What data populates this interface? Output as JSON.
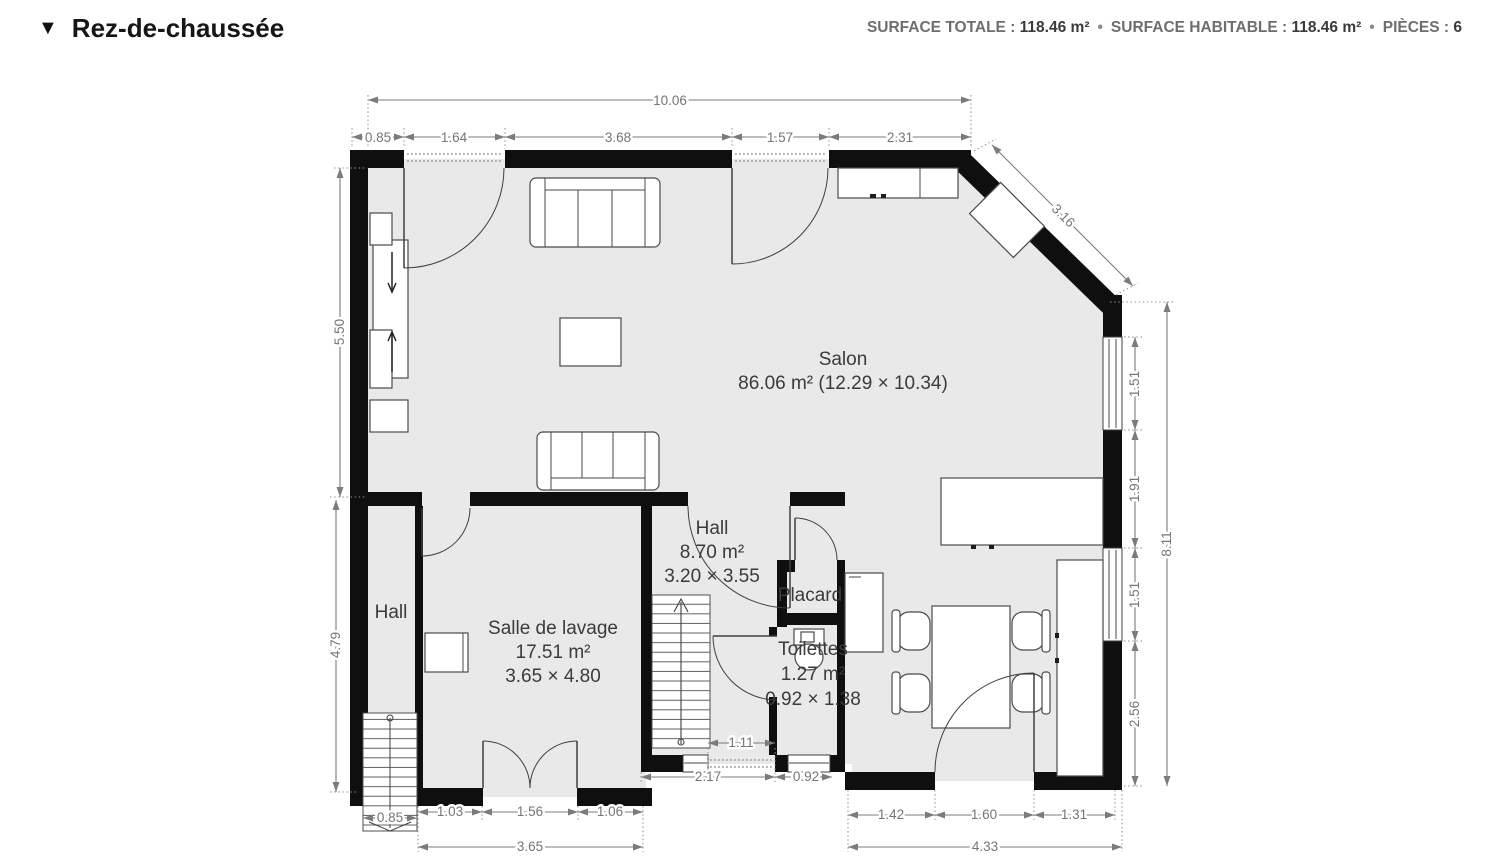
{
  "header": {
    "collapse_icon": "▼",
    "title": "Rez-de-chaussée",
    "separator": "•",
    "stats": [
      {
        "label": "SURFACE TOTALE :",
        "value": "118.46 m²"
      },
      {
        "label": "SURFACE HABITABLE :",
        "value": "118.46 m²"
      },
      {
        "label": "PIÈCES :",
        "value": "6"
      }
    ]
  },
  "rooms": {
    "salon": {
      "name": "Salon",
      "details": "86.06 m² (12.29 × 10.34)"
    },
    "hall_center": {
      "name": "Hall",
      "area": "8.70 m²",
      "size": "3.20 × 3.55"
    },
    "hall_left": {
      "name": "Hall"
    },
    "laundry": {
      "name": "Salle de lavage",
      "area": "17.51 m²",
      "size": "3.65 × 4.80"
    },
    "placard": {
      "name": "Placard"
    },
    "toilettes": {
      "name": "Toilettes",
      "area": "1.27 m²",
      "size": "0.92 × 1.38"
    }
  },
  "dims": {
    "top_total": "10.06",
    "top": [
      "0.85",
      "1.64",
      "3.68",
      "1.57",
      "2.31"
    ],
    "left_upper": "5.50",
    "left_lower": "4.79",
    "diag": "3.16",
    "right": [
      "1.51",
      "1.91",
      "1.51",
      "2.56"
    ],
    "right_total": "8.11",
    "stair": "0.85",
    "bottom_left": [
      "1.03",
      "1.56",
      "1.06"
    ],
    "bottom_left_total": "3.65",
    "notch": [
      "1.11",
      "2.17",
      "0.92"
    ],
    "bottom_right": [
      "1.42",
      "1.60",
      "1.31"
    ],
    "bottom_right_total": "4.33"
  },
  "colors": {
    "wall": "#0f0f0f",
    "floor": "#e9e9e9",
    "dimension": "#7b7b7b",
    "label": "#3b3b3b"
  }
}
